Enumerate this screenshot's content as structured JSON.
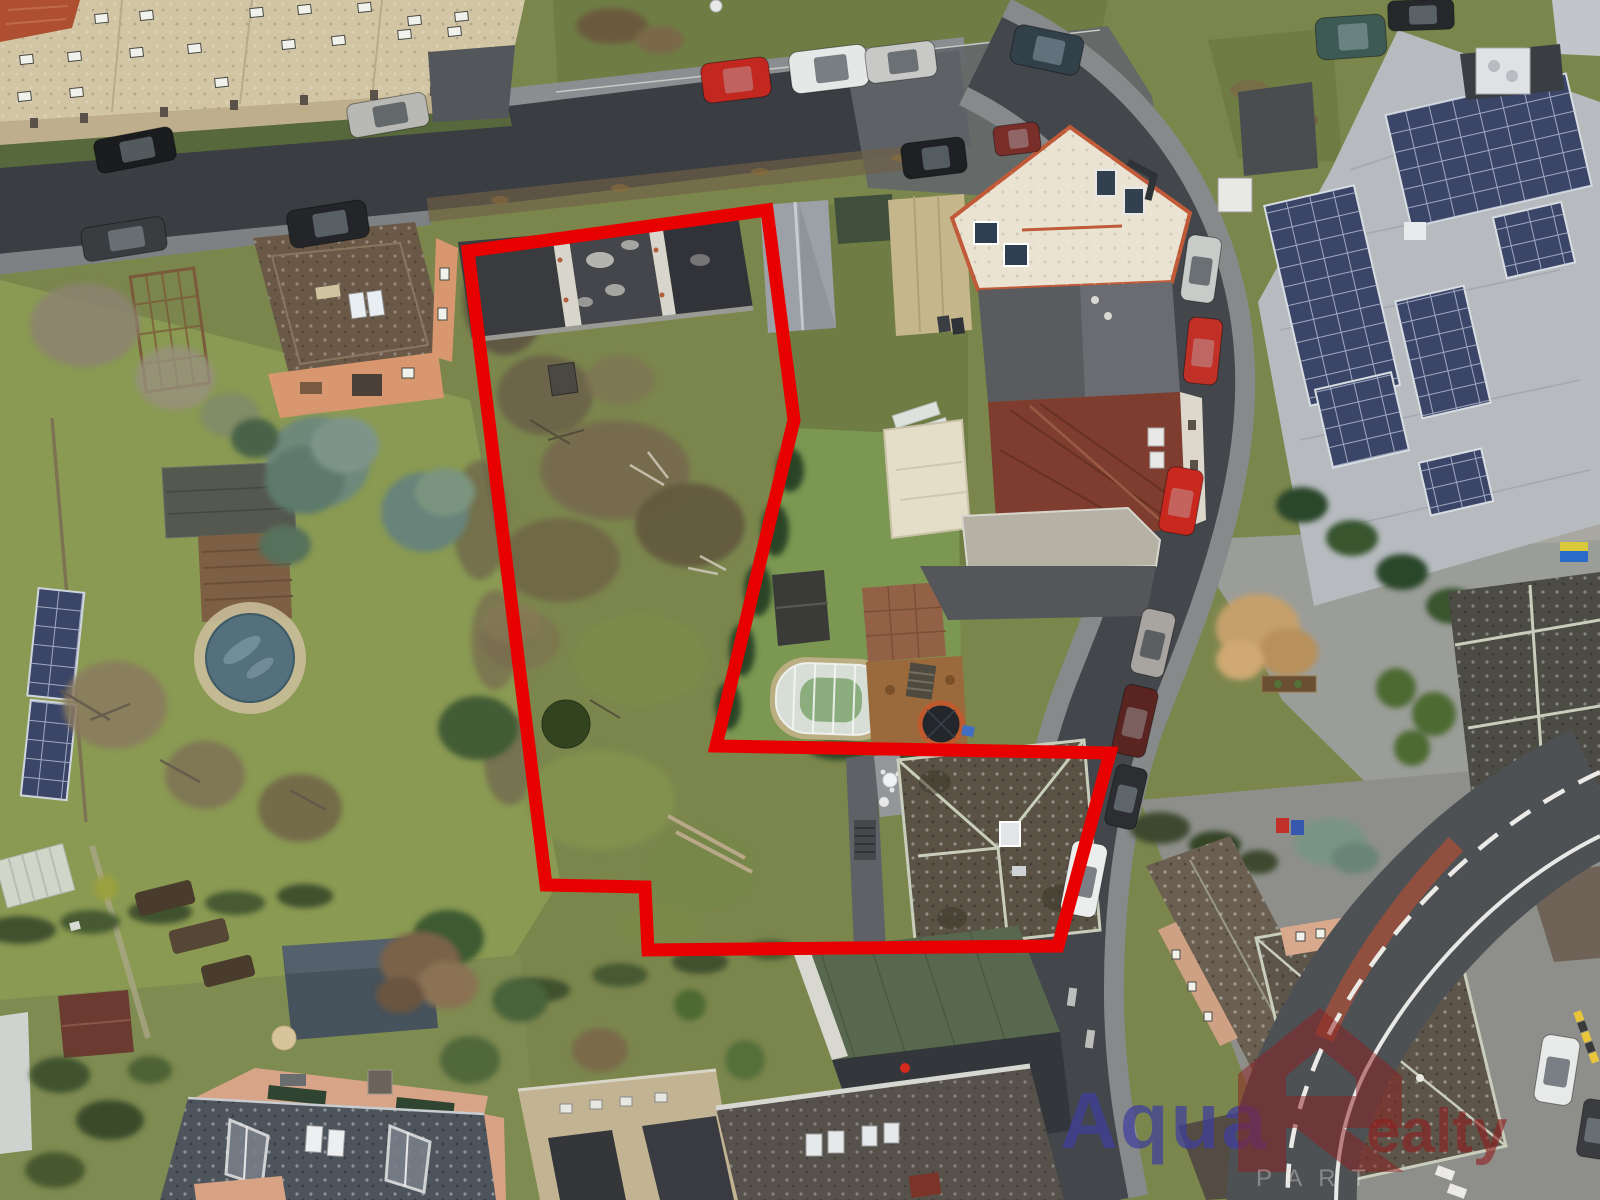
{
  "image": {
    "type": "aerial-drone-photo",
    "width": 1600,
    "height": 1200,
    "description": "Winter aerial view of a residential neighborhood; an overgrown building plot and an adjacent house are outlined with a thick red property boundary; streets with parked cars, apartment blocks, gardens, a covered round pool, solar-panel roofs and a real-estate watermark."
  },
  "watermark": {
    "text_blue": "Aqua",
    "text_red": "ealty",
    "logo": "house-shaped-R",
    "sub_text": "PART",
    "color_blue": "#3f3f9e",
    "color_red": "#8e1f1f"
  },
  "boundary": {
    "color": "#e80000",
    "stroke_width": 13,
    "points": "468,251 767,210 794,420 716,746 1110,753 1058,946 648,950 645,887 546,885"
  },
  "palette": {
    "lawn": "#7b864d",
    "lawn2": "#8a9a52",
    "lawn3": "#6f7d44",
    "scrub": "#6f6449",
    "road": "#3a3d41",
    "roadmid": "#63666a",
    "walk": "#8b8e90",
    "beige": "#d2c5a4",
    "orangeroof": "#6b5948",
    "orangewall": "#d8976e",
    "flatblack": "#3a3b3f",
    "whiteroof": "#eae3d2",
    "trim": "#c05a38",
    "grayroof": "#595b5f",
    "redroof": "#7e3d2e",
    "metal": "#b7bbc0",
    "solar": "#3b4568",
    "moss": "#5a5244",
    "greenroof": "#57684e",
    "slate": "#4e545c",
    "salmon": "#d89a80",
    "pool": "#54707c",
    "spruce": "#6e887a",
    "hedge": "#2f4527",
    "mulch": "#9a6a3c",
    "boundary": "#e80000",
    "wmblue": "#3f3f9e",
    "wmred": "#8e1f1f"
  },
  "cars": [
    {
      "x": 95,
      "y": 133,
      "w": 80,
      "h": 34,
      "rot": -11,
      "color": "#1a1c1e"
    },
    {
      "x": 348,
      "y": 98,
      "w": 80,
      "h": 34,
      "rot": -10,
      "color": "#b8b8b4"
    },
    {
      "x": 82,
      "y": 222,
      "w": 84,
      "h": 34,
      "rot": -9,
      "color": "#3a3d40"
    },
    {
      "x": 288,
      "y": 205,
      "w": 80,
      "h": 38,
      "rot": -9,
      "color": "#232528"
    },
    {
      "x": 702,
      "y": 60,
      "w": 68,
      "h": 40,
      "rot": -7,
      "color": "#c22820"
    },
    {
      "x": 790,
      "y": 48,
      "w": 78,
      "h": 42,
      "rot": -7,
      "color": "#e6e8e8"
    },
    {
      "x": 866,
      "y": 44,
      "w": 70,
      "h": 36,
      "rot": -7,
      "color": "#c8c9c6"
    },
    {
      "x": 1012,
      "y": 30,
      "w": 70,
      "h": 40,
      "rot": 12,
      "color": "#32404a"
    },
    {
      "x": 902,
      "y": 140,
      "w": 64,
      "h": 36,
      "rot": -7,
      "color": "#1e2023"
    },
    {
      "x": 994,
      "y": 124,
      "w": 46,
      "h": 30,
      "rot": -7,
      "color": "#7a2e2a"
    },
    {
      "x": 1316,
      "y": 16,
      "w": 70,
      "h": 42,
      "rot": -4,
      "color": "#3e5a55"
    },
    {
      "x": 1388,
      "y": 0,
      "w": 66,
      "h": 30,
      "rot": -2,
      "color": "#26282b"
    },
    {
      "x": 1184,
      "y": 236,
      "w": 34,
      "h": 66,
      "rot": 8,
      "color": "#c9cbc9"
    },
    {
      "x": 1186,
      "y": 318,
      "w": 34,
      "h": 66,
      "rot": 6,
      "color": "#c03026"
    },
    {
      "x": 1163,
      "y": 468,
      "w": 36,
      "h": 66,
      "rot": 10,
      "color": "#c8281e"
    },
    {
      "x": 1136,
      "y": 610,
      "w": 34,
      "h": 66,
      "rot": 13,
      "color": "#a8a5a0"
    },
    {
      "x": 1118,
      "y": 686,
      "w": 34,
      "h": 70,
      "rot": 13,
      "color": "#5a2420"
    },
    {
      "x": 1110,
      "y": 766,
      "w": 32,
      "h": 62,
      "rot": 13,
      "color": "#2c2e32"
    },
    {
      "x": 1066,
      "y": 842,
      "w": 36,
      "h": 74,
      "rot": 11,
      "color": "#eceeee"
    },
    {
      "x": 1538,
      "y": 1036,
      "w": 38,
      "h": 68,
      "rot": 9,
      "color": "#e8eaea"
    },
    {
      "x": 1580,
      "y": 1100,
      "w": 30,
      "h": 58,
      "rot": 9,
      "color": "#3a3c40"
    }
  ]
}
